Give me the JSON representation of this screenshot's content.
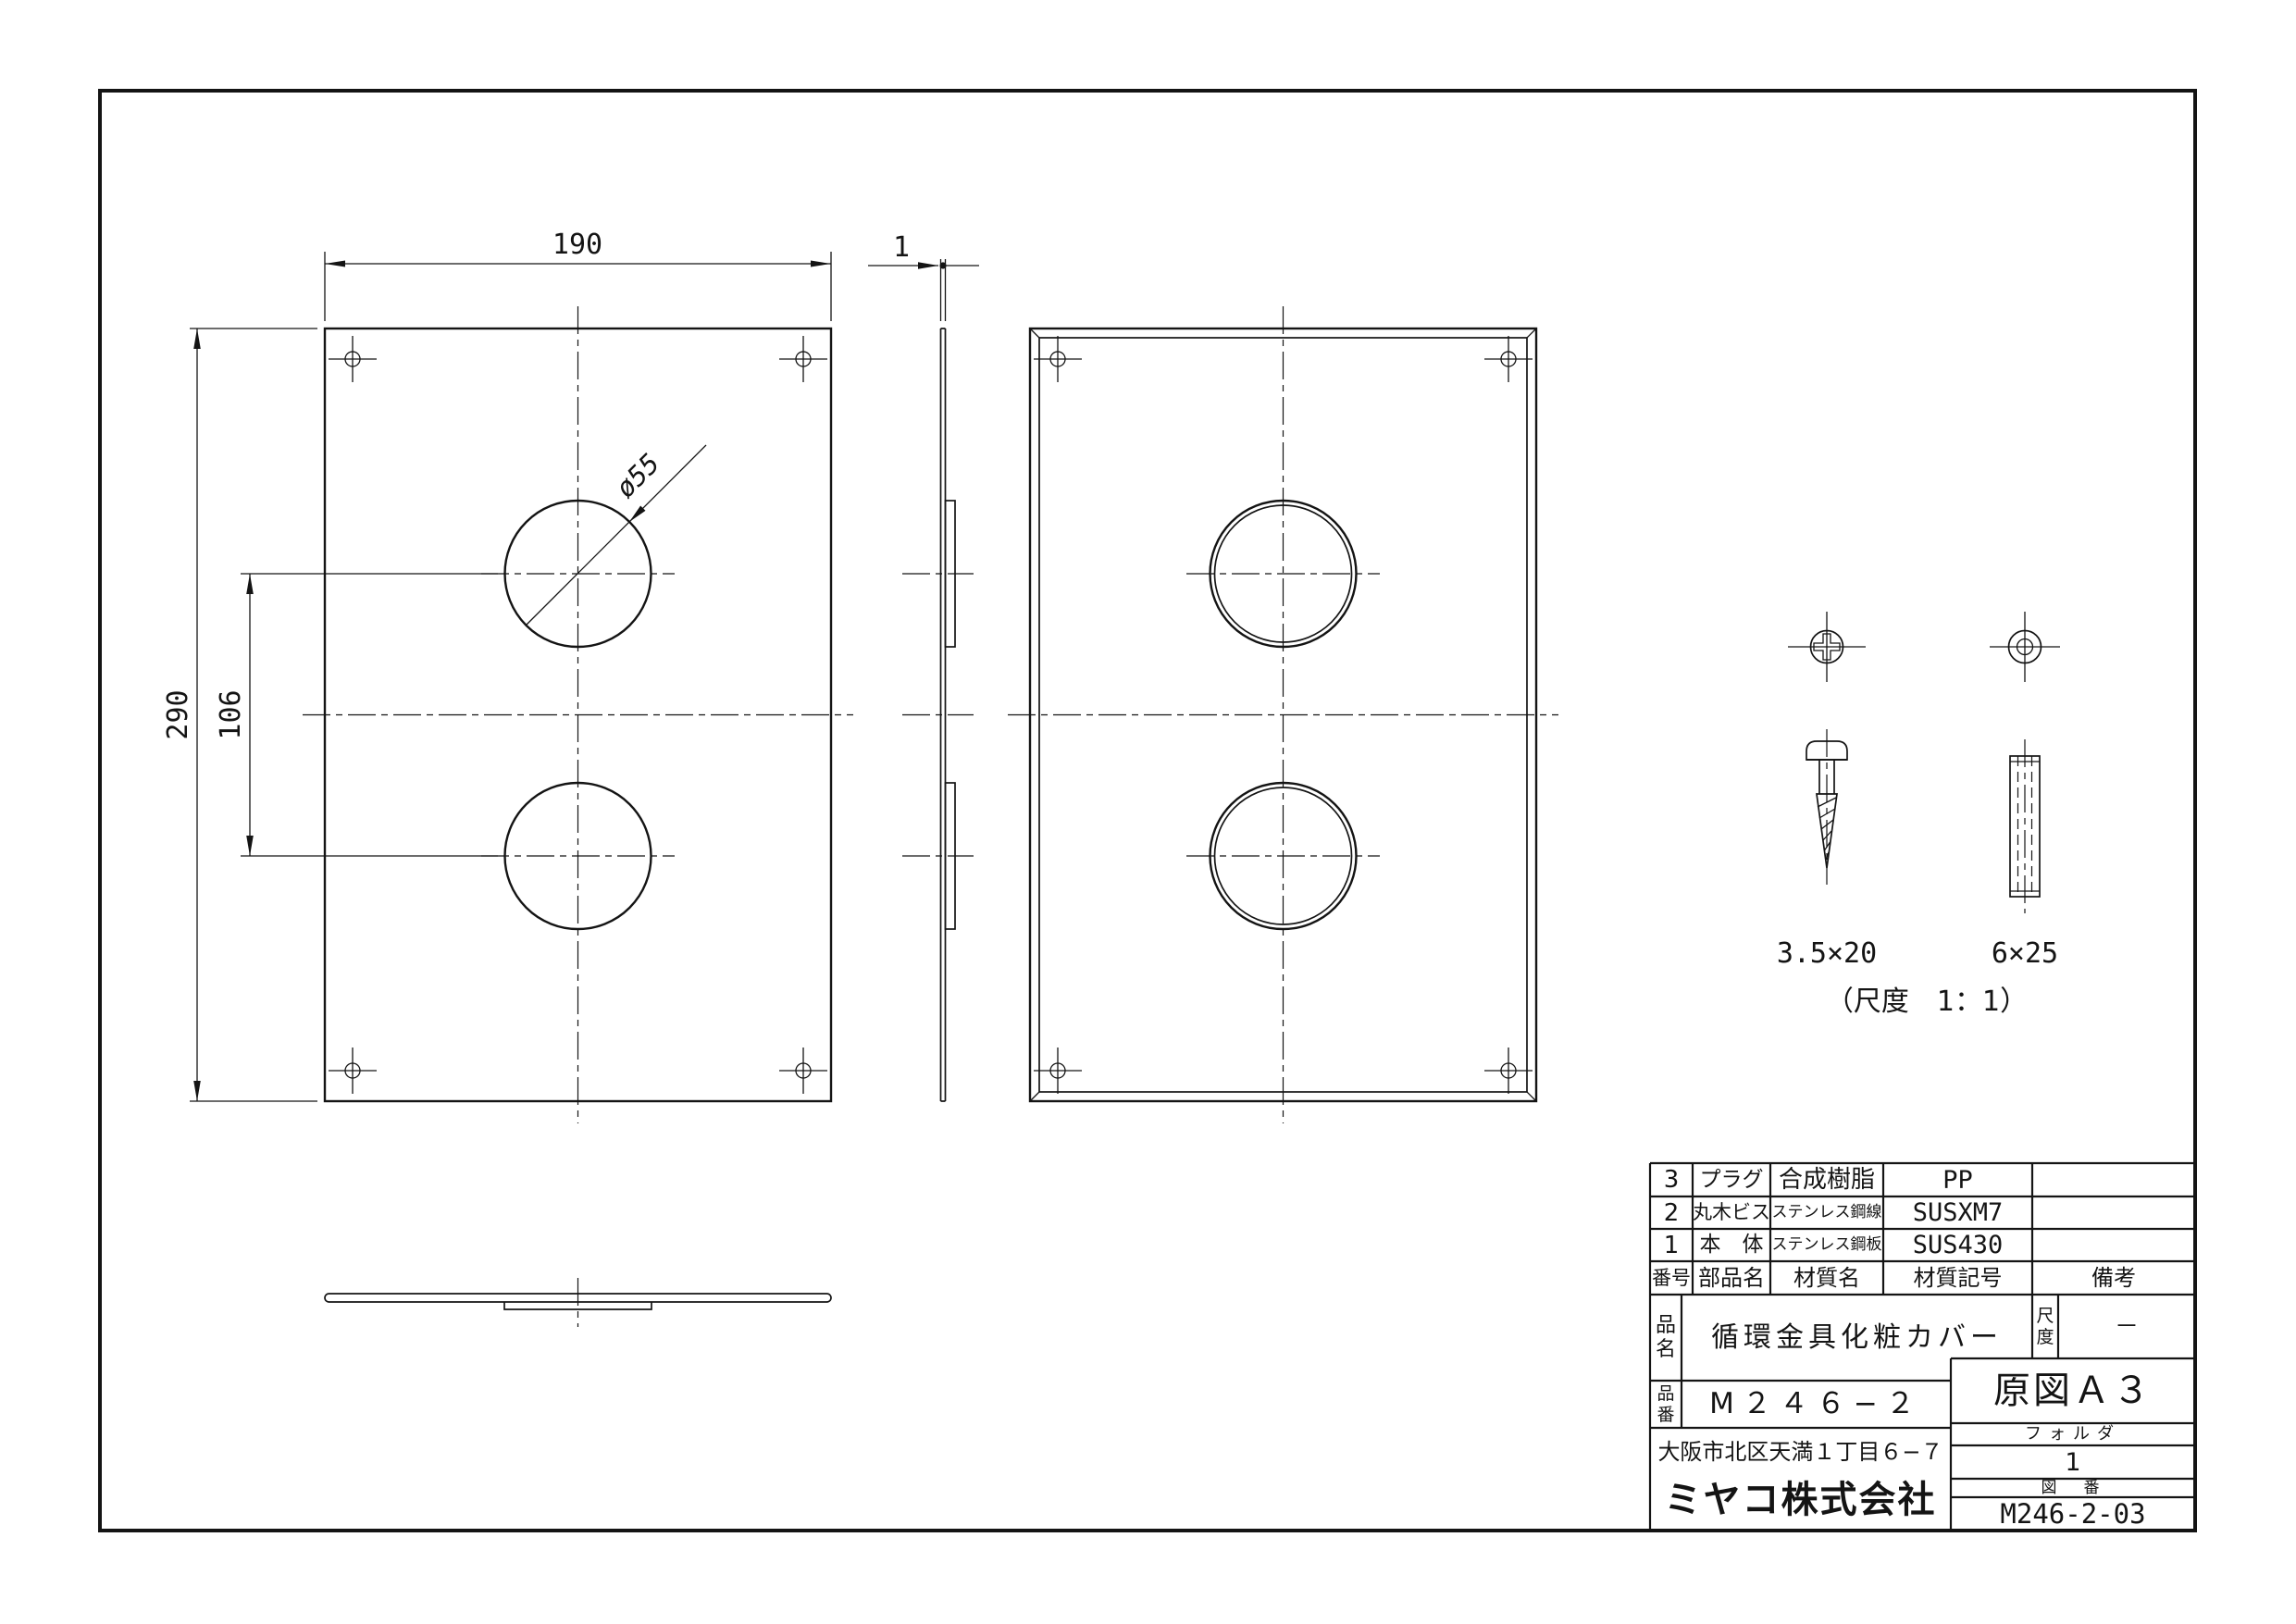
{
  "drawing": {
    "dims": {
      "width": "190",
      "height": "290",
      "hole_pitch": "106",
      "hole_dia": "ø55",
      "thickness": "1"
    },
    "hardware": {
      "screw_size": "3.5×20",
      "plug_size": "6×25",
      "scale_note": "（尺度　1：1）"
    }
  },
  "title_block": {
    "parts_table": {
      "headers": {
        "no": "番号",
        "name": "部品名",
        "material": "材質名",
        "material_code": "材質記号",
        "remarks": "備考"
      },
      "rows": [
        {
          "no": "3",
          "name": "プラグ",
          "material": "合成樹脂",
          "material_code": "PP",
          "remarks": ""
        },
        {
          "no": "2",
          "name": "丸木ビス",
          "material": "ステンレス鋼線",
          "material_code": "SUSXM7",
          "remarks": ""
        },
        {
          "no": "1",
          "name": "本　体",
          "material": "ステンレス鋼板",
          "material_code": "SUS430",
          "remarks": ""
        }
      ]
    },
    "product": {
      "label": "品名",
      "value": "循環金具化粧カバー"
    },
    "part_no": {
      "label": "品番",
      "value": "M２４６−２"
    },
    "scale": {
      "label": "尺度",
      "value": "－"
    },
    "original": {
      "value": "原図Ａ３"
    },
    "folder": {
      "label": "フォルダ",
      "value": "1"
    },
    "drawing_no": {
      "label": "図　番",
      "value": "M246-2-03"
    },
    "company": {
      "address": "大阪市北区天満１丁目６−７",
      "name": "ミヤコ株式会社"
    }
  }
}
